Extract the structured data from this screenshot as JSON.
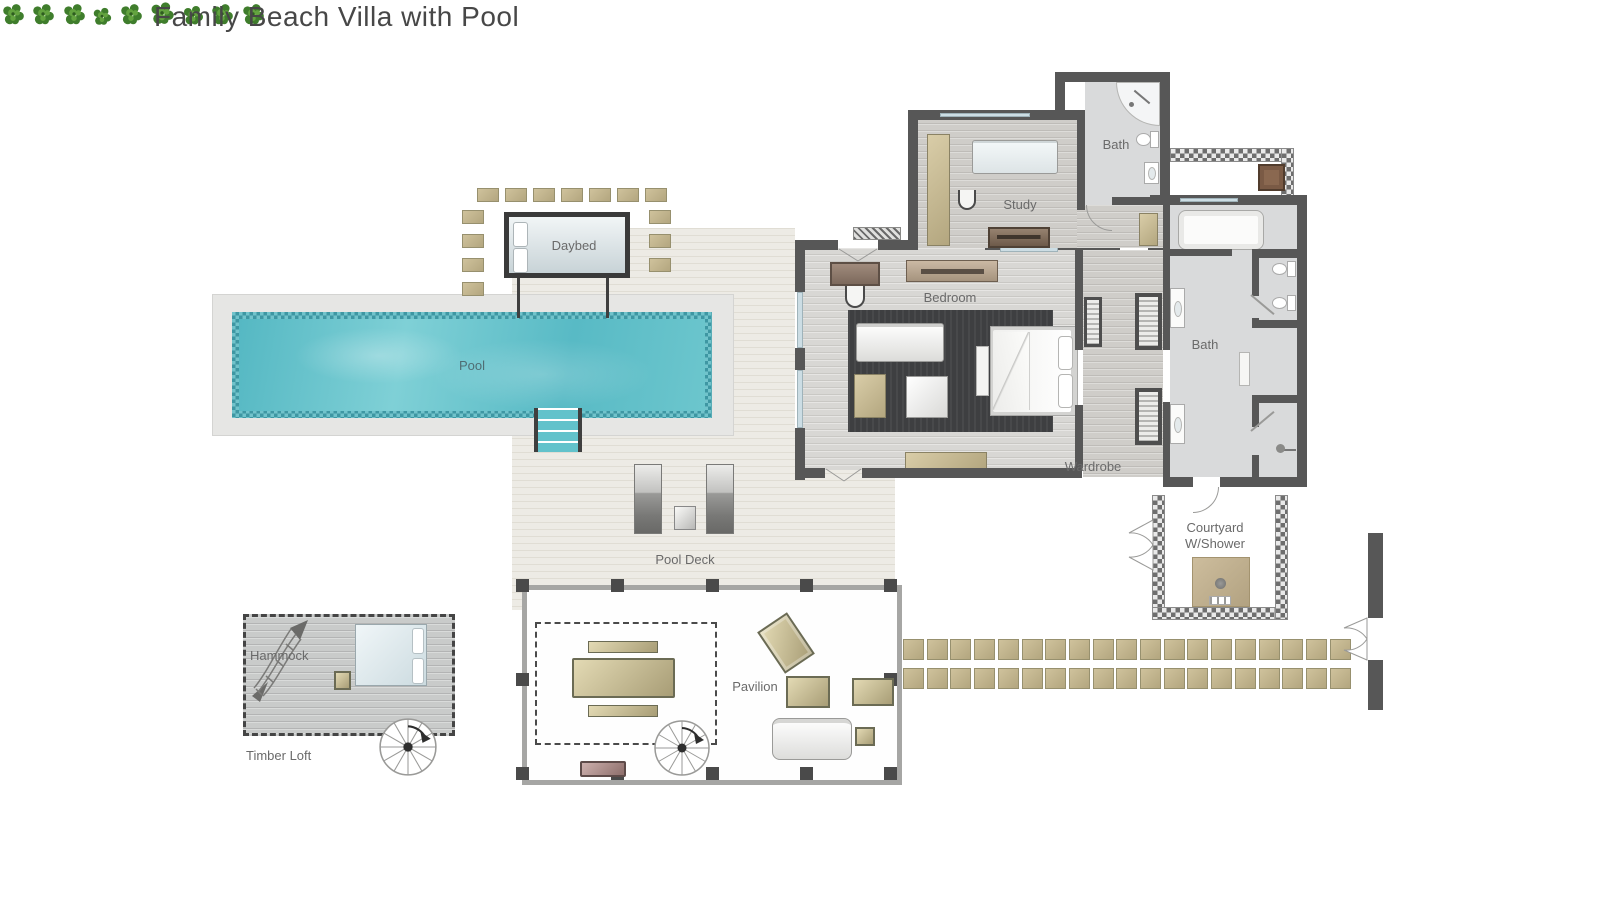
{
  "title": "Family Beach Villa with Pool",
  "labels": {
    "pool": "Pool",
    "daybed": "Daybed",
    "pool_deck": "Pool Deck",
    "bedroom": "Bedroom",
    "study": "Study",
    "study_bath": "Bath",
    "main_bath": "Bath",
    "wardrobe": "Wardrobe",
    "courtyard_line1": "Courtyard",
    "courtyard_line2": "W/Shower",
    "pavilion": "Pavilion",
    "hammock": "Hammock",
    "timber_loft": "Timber Loft"
  },
  "colors": {
    "wall": "#575757",
    "pool_water": "#5fc0ca",
    "pool_tile": "#3e97a3",
    "deck": "#edebe5",
    "stepping_stone": "#c9bc96",
    "furniture_tan": "#cec29a",
    "rug": "#3e3f41",
    "plant_green": "#3f7d2c",
    "glass": "#ccdde4",
    "label_text": "#6a6a6a"
  },
  "icons": [
    "plant-icon",
    "spiral-staircase-icon",
    "hammock-icon",
    "shower-head-icon",
    "door-swing-icon"
  ]
}
